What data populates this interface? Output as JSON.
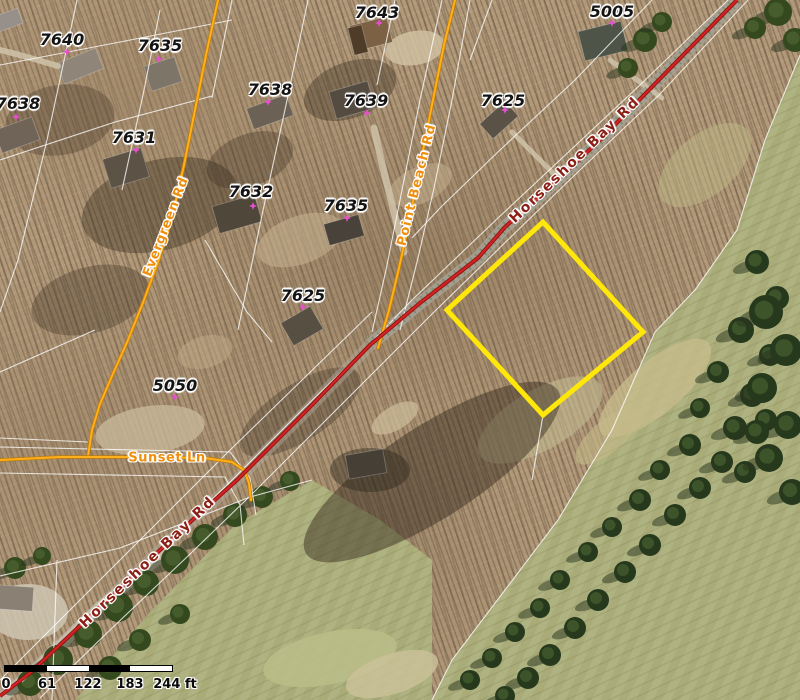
{
  "map": {
    "parcel_labels": [
      {
        "text": "7640",
        "x": 62,
        "y": 40
      },
      {
        "text": "7635",
        "x": 160,
        "y": 46
      },
      {
        "text": "7638",
        "x": 18,
        "y": 104
      },
      {
        "text": "7631",
        "x": 134,
        "y": 138
      },
      {
        "text": "7638",
        "x": 270,
        "y": 90
      },
      {
        "text": "7643",
        "x": 377,
        "y": 13
      },
      {
        "text": "7639",
        "x": 366,
        "y": 101
      },
      {
        "text": "7625",
        "x": 503,
        "y": 101
      },
      {
        "text": "5005",
        "x": 612,
        "y": 12
      },
      {
        "text": "7632",
        "x": 251,
        "y": 192
      },
      {
        "text": "7635",
        "x": 346,
        "y": 206
      },
      {
        "text": "7625",
        "x": 303,
        "y": 296
      },
      {
        "text": "5050",
        "x": 175,
        "y": 386
      }
    ],
    "point_markers": [
      {
        "x": 67,
        "y": 52
      },
      {
        "x": 159,
        "y": 59
      },
      {
        "x": 16,
        "y": 117
      },
      {
        "x": 136,
        "y": 150
      },
      {
        "x": 268,
        "y": 102
      },
      {
        "x": 379,
        "y": 23
      },
      {
        "x": 367,
        "y": 113
      },
      {
        "x": 505,
        "y": 110
      },
      {
        "x": 612,
        "y": 23
      },
      {
        "x": 253,
        "y": 206
      },
      {
        "x": 347,
        "y": 218
      },
      {
        "x": 303,
        "y": 307
      },
      {
        "x": 175,
        "y": 397
      }
    ],
    "road_labels": [
      {
        "text": "Evergreen Rd",
        "x": 166,
        "y": 227,
        "angle": -69,
        "kind": "minor",
        "ls": 0.5
      },
      {
        "text": "Point Beach Rd",
        "x": 417,
        "y": 185,
        "angle": -76,
        "kind": "minor",
        "ls": 1
      },
      {
        "text": "Sunset Ln",
        "x": 167,
        "y": 458,
        "angle": 0,
        "kind": "minor",
        "ls": 0.5
      },
      {
        "text": "Horseshoe Bay Rd",
        "x": 575,
        "y": 160,
        "angle": -44,
        "kind": "major",
        "ls": 2
      },
      {
        "text": "Horseshoe Bay Rd",
        "x": 148,
        "y": 562,
        "angle": -44,
        "kind": "major",
        "ls": 2.5
      }
    ],
    "selected_parcel": {
      "points": "543,222 643,332 543,415 447,310",
      "color": "#ffe70a",
      "stroke_width": 5
    },
    "roads": {
      "major_color": "#d42222",
      "major_casing": "#8c1414",
      "minor_color": "#ffb01c",
      "minor_casing": "#c07c08",
      "horseshoe_bay": "737,0 647,92 600,140 540,196 505,227 478,258 420,303 370,345 307,410 237,480 178,533 100,607 30,673 0,696",
      "horseshoe_upper": "737,0 647,92 600,140 540,196 505,227 478,258 420,303 370,345",
      "horseshoe_lower": "370,345 307,410 237,480 178,533 100,607 30,673 0,696",
      "horseshoe_sw_pavement": "175,545 100,607 40,665 0,700",
      "evergreen": "218,0 206,55 195,110 184,165 172,218 158,262 144,300 128,340 112,376 100,404 92,430 88,456",
      "sunset": "0,460 60,457 130,457 205,458 232,462 244,470 249,483 251,500",
      "point_beach": "455,0 444,45 432,105 420,165 409,222 399,268 389,310 381,338 378,348"
    },
    "parcel_line_color": "rgba(255,255,255,0.78)",
    "parcel_lines": [
      "77,0 47,140 18,260 0,312",
      "160,10 143,95 122,190",
      "232,0 212,98",
      "308,0 286,105 262,215 238,330",
      "395,0 377,85",
      "492,0 470,60",
      "0,65 120,42 232,20",
      "0,160 115,122 212,96",
      "0,372 95,330",
      "205,240 247,312 272,342",
      "0,447 230,452 250,478 256,515",
      "0,473 225,477 240,505 244,545",
      "800,55 765,140 737,230 695,290 655,332 612,430 558,520 505,590 452,660 432,700",
      "652,0 575,80 500,150 440,208 412,238",
      "372,312 300,382 228,452 158,522 88,592 18,662 0,680",
      "0,576 120,548 250,497 312,480",
      "442,0 420,100 402,190 386,270 372,332",
      "470,0 452,100 434,188 418,258 400,330",
      "57,560 52,700",
      "0,438 88,442",
      "543,415 532,480",
      "728,0 640,85 560,160 498,218 412,300 362,352 300,412 230,482 170,540 92,614 22,682",
      "748,0 660,94 580,170 518,230 432,314 382,364 318,428 248,498 188,556 110,630 40,698"
    ],
    "scale_bar": {
      "x": 4,
      "y": 665,
      "bar_w": 167,
      "bar_h": 5,
      "colors": [
        "#000000",
        "#ffffff",
        "#000000",
        "#ffffff"
      ],
      "labels": [
        {
          "text": "0",
          "px": 6
        },
        {
          "text": "61",
          "px": 47
        },
        {
          "text": "122",
          "px": 88
        },
        {
          "text": "183",
          "px": 130
        },
        {
          "text": "244 ft",
          "px": 175
        }
      ],
      "label_y_offset": 9
    }
  },
  "scenery": {
    "grass_color": "#a9ac78",
    "golf_polygons": [
      "800,55 765,140 737,230 695,290 655,332 612,430 558,520 505,590 452,660 432,700 800,700",
      "75,700 150,612 235,525 312,480 380,520 432,560 432,700"
    ],
    "light_blobs": [
      [
        300,
        240,
        45,
        24,
        -20,
        "#c6b28f",
        0.55
      ],
      [
        420,
        185,
        34,
        18,
        -25,
        "#c6b28f",
        0.5
      ],
      [
        205,
        352,
        28,
        16,
        -15,
        "#c0ac89",
        0.45
      ],
      [
        150,
        430,
        55,
        24,
        -8,
        "#cabb9b",
        0.75
      ],
      [
        415,
        48,
        30,
        17,
        -10,
        "#d3c4a4",
        0.8
      ],
      [
        28,
        612,
        40,
        28,
        0,
        "#cfc6b2",
        0.85
      ],
      [
        395,
        418,
        26,
        12,
        -30,
        "#cdbd9a",
        0.7
      ],
      [
        655,
        388,
        70,
        26,
        -40,
        "#c8bd8c",
        0.75
      ],
      [
        608,
        436,
        40,
        16,
        -40,
        "#c4b988",
        0.6
      ],
      [
        330,
        658,
        68,
        26,
        -12,
        "#b9bd86",
        0.9
      ],
      [
        392,
        674,
        48,
        20,
        -18,
        "#ccc29a",
        0.8
      ],
      [
        705,
        165,
        55,
        30,
        -40,
        "#bdb886",
        0.5
      ],
      [
        540,
        420,
        70,
        30,
        -30,
        "#c2b98f",
        0.6
      ]
    ],
    "dark_blobs": [
      [
        160,
        205,
        80,
        45,
        -15,
        "rgba(56,44,31,0.40)"
      ],
      [
        90,
        300,
        60,
        33,
        -15,
        "rgba(56,44,31,0.32)"
      ],
      [
        350,
        90,
        48,
        28,
        -20,
        "rgba(56,44,31,0.38)"
      ],
      [
        250,
        160,
        45,
        26,
        -20,
        "rgba(56,44,31,0.32)"
      ],
      [
        432,
        472,
        150,
        46,
        -33,
        "rgba(48,38,26,0.45)"
      ],
      [
        300,
        412,
        70,
        28,
        -33,
        "rgba(48,38,26,0.30)"
      ],
      [
        60,
        120,
        55,
        35,
        -10,
        "rgba(56,44,31,0.30)"
      ],
      [
        370,
        470,
        40,
        22,
        0,
        "rgba(40,34,24,0.40)"
      ]
    ],
    "houses": [
      [
        80,
        66,
        42,
        22,
        -22,
        "#8f8679"
      ],
      [
        163,
        74,
        32,
        26,
        -18,
        "#7d7568"
      ],
      [
        17,
        135,
        40,
        24,
        -20,
        "#6f6457"
      ],
      [
        126,
        168,
        40,
        30,
        -17,
        "#5c5346"
      ],
      [
        270,
        112,
        42,
        22,
        -20,
        "#6b6154"
      ],
      [
        371,
        34,
        38,
        26,
        -14,
        "#7d6145"
      ],
      [
        358,
        40,
        14,
        28,
        -14,
        "#4f3c28"
      ],
      [
        352,
        100,
        40,
        28,
        -16,
        "#544c41"
      ],
      [
        237,
        214,
        44,
        28,
        -16,
        "#4f4739"
      ],
      [
        344,
        230,
        36,
        22,
        -16,
        "#49423a"
      ],
      [
        499,
        120,
        34,
        20,
        -42,
        "#5a5246"
      ],
      [
        603,
        41,
        44,
        30,
        -14,
        "#4e5447"
      ],
      [
        302,
        326,
        34,
        26,
        -30,
        "#584f43"
      ],
      [
        366,
        464,
        38,
        24,
        -10,
        "#453f36"
      ],
      [
        14,
        598,
        38,
        24,
        4,
        "#8a8174"
      ],
      [
        8,
        20,
        26,
        16,
        -20,
        "#97908a"
      ]
    ],
    "driveways": [
      {
        "d": "M 404,252 C 392,205 382,165 374,128",
        "w": 7
      },
      {
        "d": "M 58,66 C 38,60 18,54 0,50",
        "w": 6
      },
      {
        "d": "M 512,132 C 532,152 548,168 560,180",
        "w": 5
      },
      {
        "d": "M 610,60 C 630,75 648,88 662,98",
        "w": 5
      }
    ],
    "driveway_color": "#d2c7ad",
    "conifer_color": "#26391d",
    "conifer_shadow": "rgba(40,52,30,0.5)",
    "conifers": [
      [
        757,
        262,
        12
      ],
      [
        777,
        298,
        12
      ],
      [
        741,
        330,
        13
      ],
      [
        770,
        355,
        11
      ],
      [
        718,
        372,
        11
      ],
      [
        752,
        395,
        12
      ],
      [
        700,
        408,
        10
      ],
      [
        735,
        428,
        12
      ],
      [
        766,
        420,
        11
      ],
      [
        690,
        445,
        11
      ],
      [
        722,
        462,
        11
      ],
      [
        660,
        470,
        10
      ],
      [
        700,
        488,
        11
      ],
      [
        745,
        472,
        11
      ],
      [
        640,
        500,
        11
      ],
      [
        675,
        515,
        11
      ],
      [
        612,
        527,
        10
      ],
      [
        650,
        545,
        11
      ],
      [
        588,
        552,
        10
      ],
      [
        625,
        572,
        11
      ],
      [
        560,
        580,
        10
      ],
      [
        598,
        600,
        11
      ],
      [
        540,
        608,
        10
      ],
      [
        575,
        628,
        11
      ],
      [
        515,
        632,
        10
      ],
      [
        550,
        655,
        11
      ],
      [
        492,
        658,
        10
      ],
      [
        528,
        678,
        11
      ],
      [
        470,
        680,
        10
      ],
      [
        505,
        696,
        10
      ],
      [
        766,
        312,
        17
      ],
      [
        786,
        350,
        16
      ],
      [
        762,
        388,
        15
      ],
      [
        788,
        425,
        14
      ],
      [
        769,
        458,
        14
      ],
      [
        792,
        492,
        13
      ],
      [
        757,
        432,
        12
      ]
    ],
    "road_trees": [
      [
        118,
        607,
        15
      ],
      [
        146,
        583,
        13
      ],
      [
        175,
        560,
        14
      ],
      [
        205,
        537,
        13
      ],
      [
        235,
        515,
        12
      ],
      [
        262,
        497,
        11
      ],
      [
        88,
        634,
        14
      ],
      [
        58,
        660,
        15
      ],
      [
        30,
        683,
        13
      ],
      [
        290,
        481,
        10
      ],
      [
        140,
        640,
        11
      ],
      [
        110,
        668,
        12
      ],
      [
        180,
        614,
        10
      ],
      [
        15,
        568,
        11
      ],
      [
        42,
        556,
        9
      ],
      [
        778,
        12,
        14
      ],
      [
        755,
        28,
        11
      ],
      [
        795,
        40,
        12
      ],
      [
        645,
        40,
        12
      ],
      [
        628,
        68,
        10
      ],
      [
        662,
        22,
        10
      ]
    ],
    "pavement_upper_color": "#a5a095",
    "pavement_lower_color": "#b5ae9f",
    "pavement_sw_color": "#cac3b2",
    "utility_green": "#47823f",
    "utility_red": "#c0392b"
  }
}
